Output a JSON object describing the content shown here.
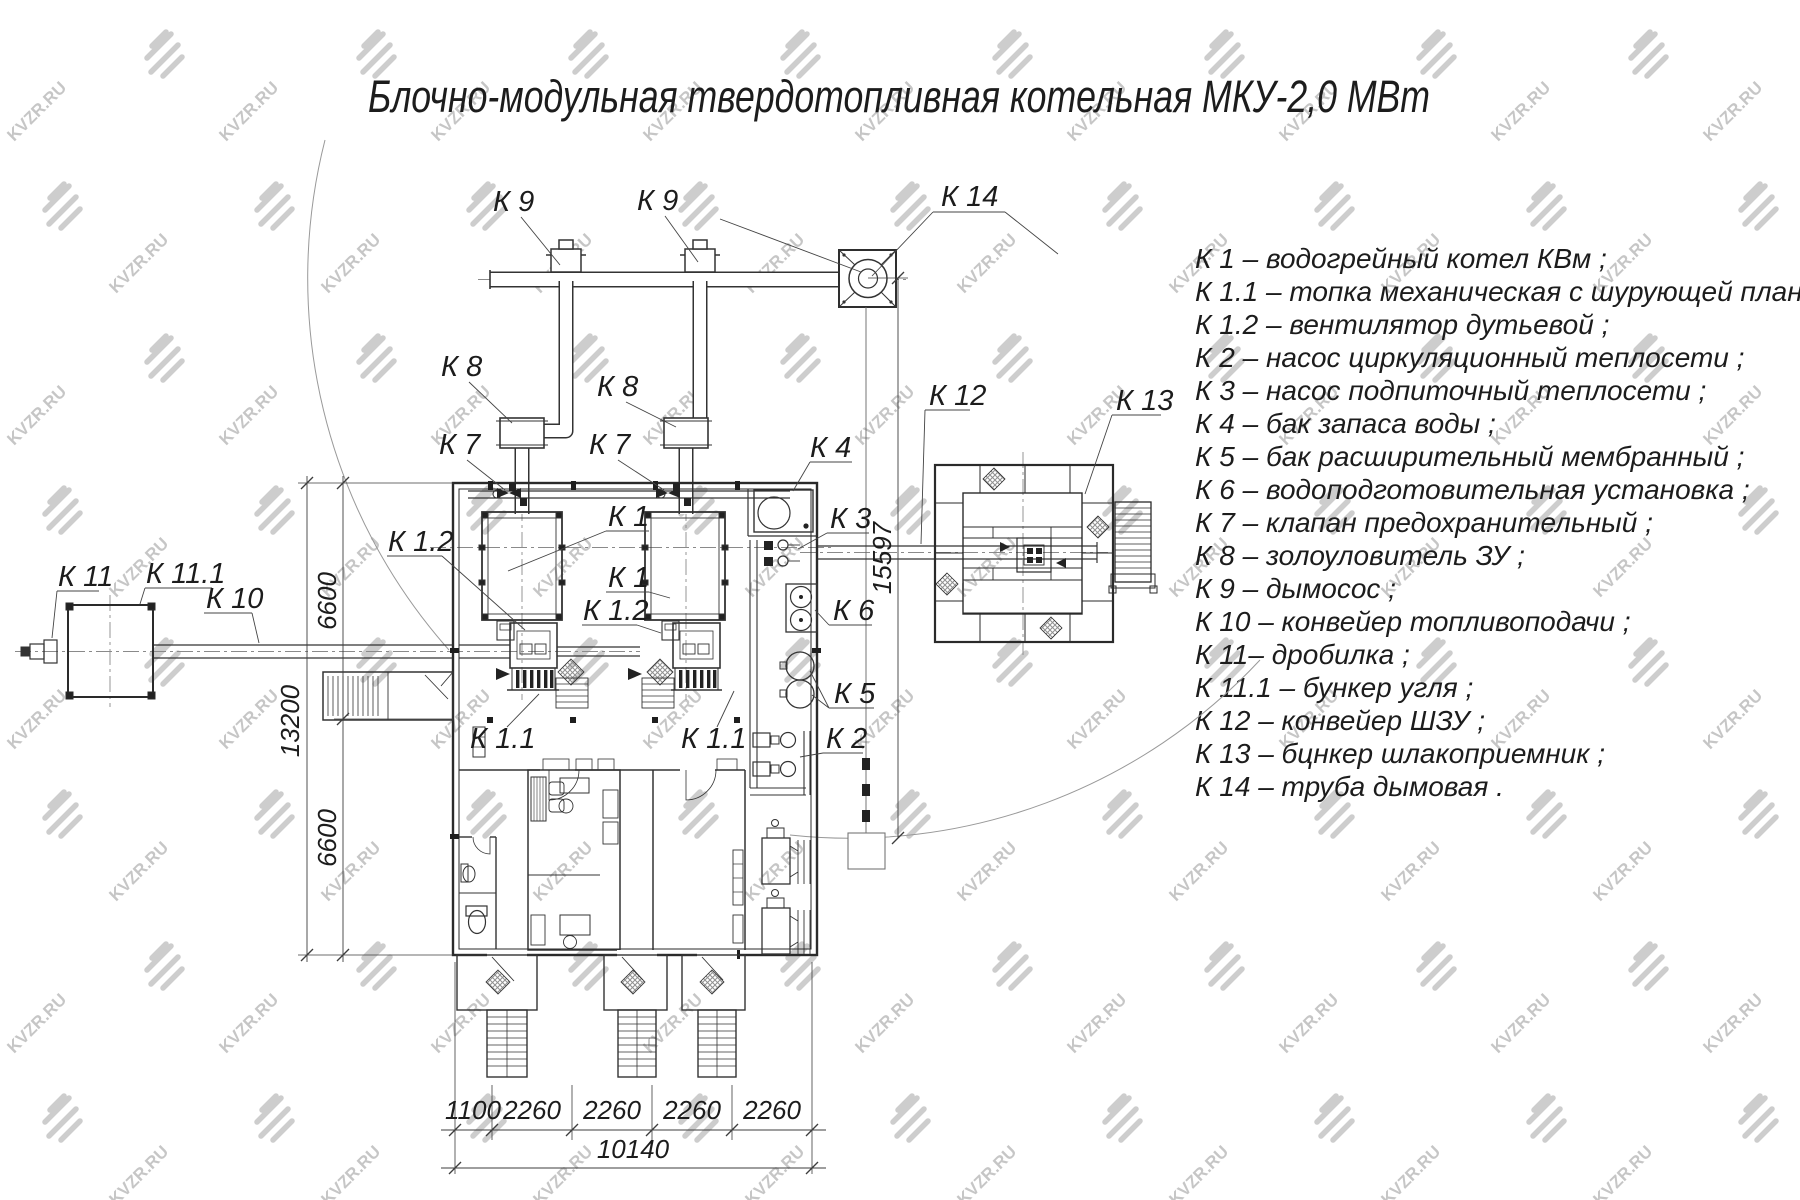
{
  "title": "Блочно-модульная твердотопливная котельная МКУ-2,0  МВт",
  "watermark": "KVZR.RU",
  "legend": {
    "items": [
      "К 1  –  водогрейный котел КВм ;",
      "К 1.1  –  топка механическая с шурующей планкой ;",
      "К 1.2  –  вентилятор дутьевой ;",
      "К 2  –  насос циркуляционный теплосети ;",
      "К 3  –  насос подпиточный теплосети ;",
      "К 4  –  бак запаса воды ;",
      "К 5  –  бак расширительный мембранный ;",
      "К 6  –  водоподготовительная установка ;",
      "К 7  –  клапан предохранительный ;",
      "К 8  –  золоуловитель ЗУ ;",
      "К 9  –  дымосос ;",
      "К 10  –  конвейер топливоподачи ;",
      "К 11–  дробилка ;",
      "К 11.1  –  бункер угля ;",
      "К 12  –  конвейер ШЗУ ;",
      "К 13  –  бцнкер шлакоприемник ;",
      "К 14  –  труба дымовая ."
    ]
  },
  "labels": {
    "k9_left": "К 9",
    "k9_right": "К 9",
    "k14": "К 14",
    "k8_left": "К 8",
    "k8_right": "К 8",
    "k7_left": "К 7",
    "k7_right": "К 7",
    "k4": "К 4",
    "k12": "К 12",
    "k13": "К 13",
    "k1_upper": "К 1",
    "k1_lower": "К 1",
    "k1_2_left": "К 1.2",
    "k1_2_right": "К 1.2",
    "k1_1_left": "К 1.1",
    "k1_1_right": "К 1.1",
    "k3": "К 3",
    "k6": "К 6",
    "k5": "К 5",
    "k2": "К 2",
    "k11": "К 11",
    "k11_1": "К 11.1",
    "k10": "К 10"
  },
  "dimensions": {
    "left_upper": "6600",
    "left_total": "13200",
    "left_lower": "6600",
    "chimney_height": "15597",
    "bottom_segments": [
      "1100",
      "2260",
      "2260",
      "2260",
      "2260"
    ],
    "bottom_total": "10140"
  }
}
